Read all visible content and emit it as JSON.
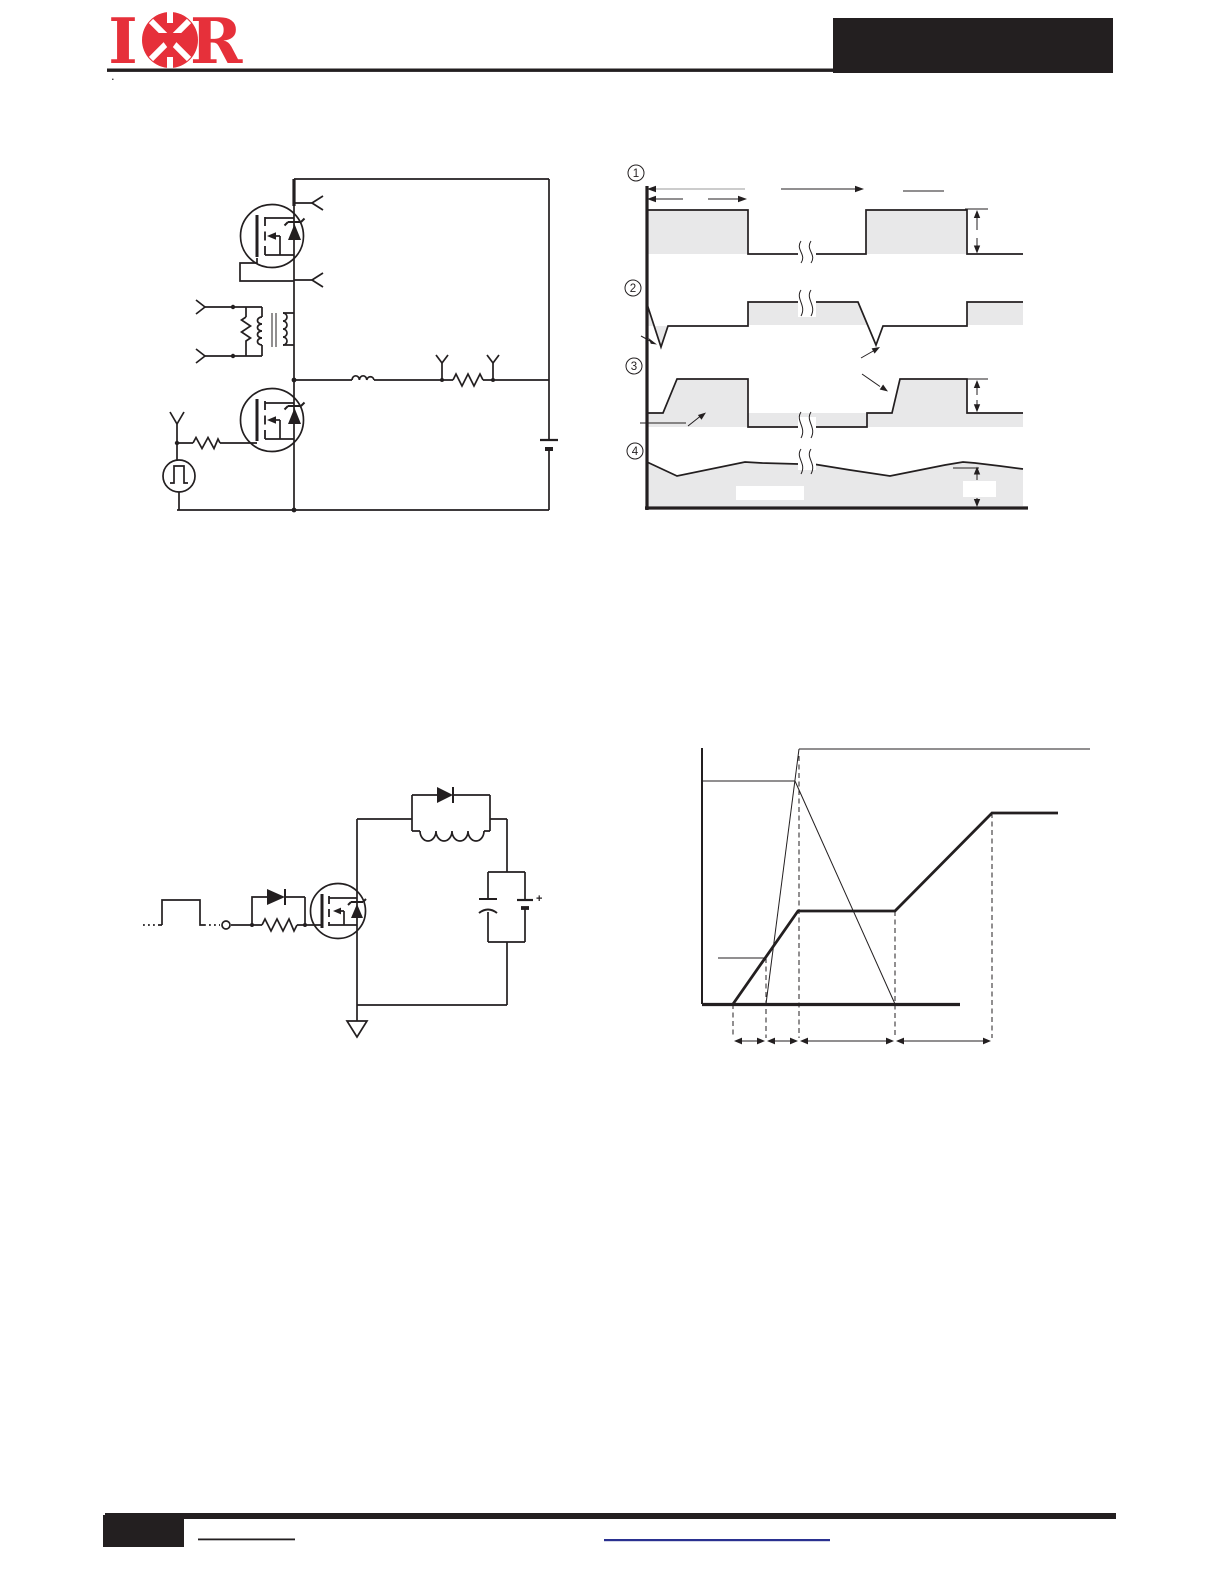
{
  "page": {
    "stray_dot": "."
  },
  "header": {
    "logo": {
      "letter_left": "I",
      "letter_right": "R",
      "color": "#e6303a"
    },
    "rule_color": "#231f20",
    "title_box_color": "#231f20"
  },
  "figures": {
    "dvdt_waveforms": {
      "markers": [
        "1",
        "2",
        "3",
        "4"
      ],
      "fill_color": "#e8e8e9",
      "line_color": "#231f20"
    },
    "dvdt_circuit": {
      "line_color": "#231f20"
    },
    "gate_charge_circuit": {
      "battery_plus": "+",
      "line_color": "#231f20"
    },
    "gate_charge_waveform": {
      "line_color": "#231f20"
    }
  },
  "footer": {
    "bar_color": "#231f20",
    "page_box_color": "#231f20",
    "note_rule_color": "#231f20",
    "link_underline_color": "#2a3190"
  }
}
